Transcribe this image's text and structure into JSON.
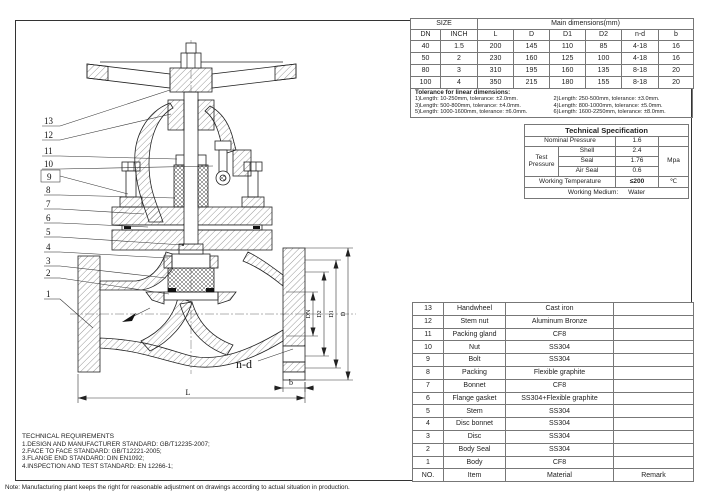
{
  "sheet": {
    "note": "Note: Manufacturing plant keeps the right for reasonable adjustment on drawings according to actual situation in production."
  },
  "size_table": {
    "size_header": "SIZE",
    "main_header": "Main dimensions(mm)",
    "columns": [
      "DN",
      "INCH",
      "L",
      "D",
      "D1",
      "D2",
      "n-d",
      "b"
    ],
    "rows": [
      [
        "40",
        "1.5",
        "200",
        "145",
        "110",
        "85",
        "4-18",
        "16"
      ],
      [
        "50",
        "2",
        "230",
        "160",
        "125",
        "100",
        "4-18",
        "16"
      ],
      [
        "80",
        "3",
        "310",
        "195",
        "160",
        "135",
        "8-18",
        "20"
      ],
      [
        "100",
        "4",
        "350",
        "215",
        "180",
        "155",
        "8-18",
        "20"
      ]
    ]
  },
  "tolerance": {
    "title": "Tolerance for linear dimensions:",
    "items": [
      "1)Length: 10-250mm, tolerance: ±2.0mm.",
      "2)Length: 250-500mm, tolerance: ±3.0mm.",
      "3)Length: 500-800mm, tolerance: ±4.0mm.",
      "4)Length: 800-1000mm, tolerance: ±5.0mm.",
      "5)Length: 1000-1600mm, tolerance: ±6.0mm.",
      "6)Length: 1600-2250mm, tolerance: ±8.0mm."
    ]
  },
  "tech_spec": {
    "title": "Technical  Specification",
    "nominal_pressure_label": "Nominal Pressure",
    "nominal_pressure_value": "1.6",
    "test_pressure_label": "Test Pressure",
    "shell_label": "Shell",
    "shell_value": "2.4",
    "seal_label": "Seal",
    "seal_value": "1.76",
    "air_seal_label": "Air Seal",
    "air_seal_value": "0.6",
    "pressure_unit": "Mpa",
    "working_temp_label": "Working Temperature",
    "working_temp_value": "≤200",
    "temp_unit": "℃",
    "working_medium_label": "Working Medium:",
    "working_medium_value": "Water"
  },
  "parts_table": {
    "rows": [
      {
        "no": "13",
        "item": "Handwheel",
        "material": "Cast iron",
        "remark": ""
      },
      {
        "no": "12",
        "item": "Stem nut",
        "material": "Aluminum Bronze",
        "remark": ""
      },
      {
        "no": "11",
        "item": "Packing gland",
        "material": "CF8",
        "remark": ""
      },
      {
        "no": "10",
        "item": "Nut",
        "material": "SS304",
        "remark": ""
      },
      {
        "no": "9",
        "item": "Bolt",
        "material": "SS304",
        "remark": ""
      },
      {
        "no": "8",
        "item": "Packing",
        "material": "Flexible graphite",
        "remark": ""
      },
      {
        "no": "7",
        "item": "Bonnet",
        "material": "CF8",
        "remark": ""
      },
      {
        "no": "6",
        "item": "Flange gasket",
        "material": "SS304+Flexible graphite",
        "remark": ""
      },
      {
        "no": "5",
        "item": "Stem",
        "material": "SS304",
        "remark": ""
      },
      {
        "no": "4",
        "item": "Disc bonnet",
        "material": "SS304",
        "remark": ""
      },
      {
        "no": "3",
        "item": "Disc",
        "material": "SS304",
        "remark": ""
      },
      {
        "no": "2",
        "item": "Body Seal",
        "material": "SS304",
        "remark": ""
      },
      {
        "no": "1",
        "item": "Body",
        "material": "CF8",
        "remark": ""
      }
    ],
    "footer": {
      "no": "NO.",
      "item": "Item",
      "material": "Material",
      "remark": "Remark"
    }
  },
  "tech_requirements": {
    "title": "TECHNICAL REQUIREMENTS",
    "items": [
      "1.DESIGN AND MANUFACTURER STANDARD: GB/T12235-2007;",
      "2.FACE TO FACE STANDARD: GB/T12221-2005;",
      "3.FLANGE END STANDARD: DIN EN1092;",
      "4.INSPECTION AND TEST STANDARD: EN 12266-1;"
    ]
  },
  "drawing": {
    "callouts": [
      "13",
      "12",
      "11",
      "10",
      "9",
      "8",
      "7",
      "6",
      "5",
      "4",
      "3",
      "2",
      "1"
    ],
    "dims": {
      "length": "L",
      "flange_width": "b",
      "bolt_holes": "n-d",
      "bore": "DN",
      "d2": "D2",
      "d1": "D1",
      "outer_dia": "D"
    }
  }
}
